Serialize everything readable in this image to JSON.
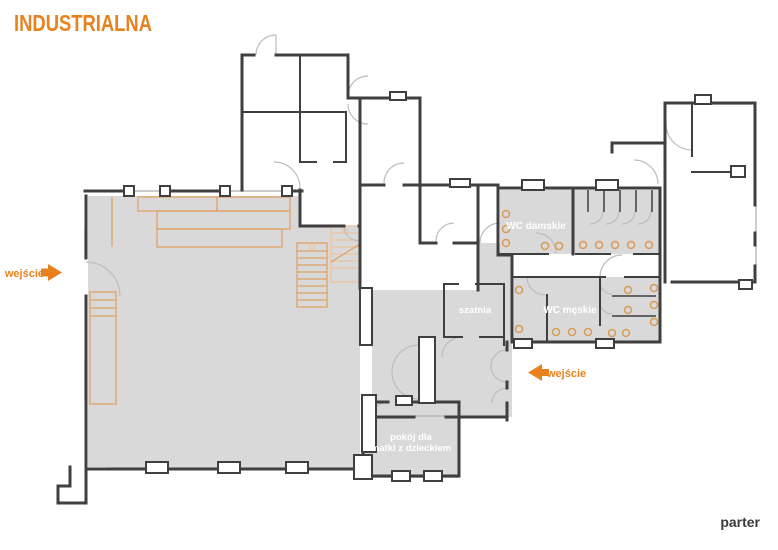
{
  "logo": "INDUSTRIALNA",
  "floor_label": "parter",
  "rooms": {
    "wc_women": "WC damskie",
    "wc_men": "WC męskie",
    "cloakroom": "szatnia",
    "mother_child_line1": "pokój dla",
    "mother_child_line2": "matki z dzieckiem"
  },
  "entrances": {
    "left": "wejście",
    "right": "wejście"
  },
  "colors": {
    "accent_orange": "#E8821E",
    "furniture_orange": "#DFA266",
    "room_fill_gray": "#D9D9D9",
    "wall_dark": "#3F3F3F",
    "room_label": "#FFFFFF",
    "floor_label": "#3A3A3A"
  }
}
